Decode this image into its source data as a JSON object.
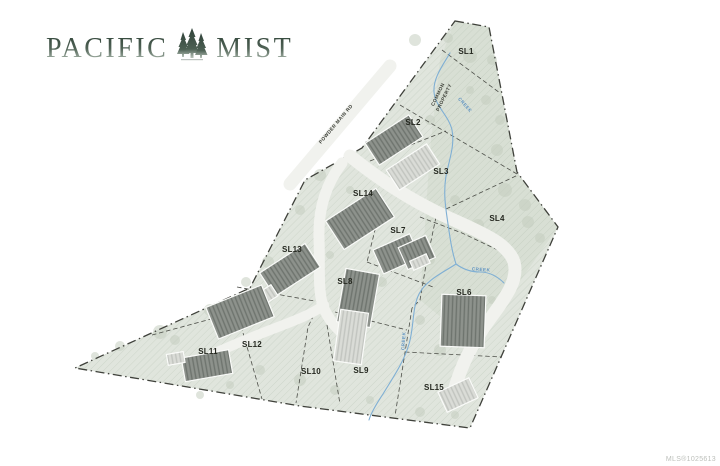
{
  "logo": {
    "word_left": "PACIFIC",
    "word_right": "MIST",
    "icon": "pine-tree-cluster-icon"
  },
  "map": {
    "road_label": "POWDER MAIN RD",
    "common_property_line1": "COMMON",
    "common_property_line2": "PROPERTY",
    "creek_label": "CREEK",
    "lots": [
      {
        "id": "SL1"
      },
      {
        "id": "SL2"
      },
      {
        "id": "SL3"
      },
      {
        "id": "SL4"
      },
      {
        "id": "SL6"
      },
      {
        "id": "SL7"
      },
      {
        "id": "SL8"
      },
      {
        "id": "SL9"
      },
      {
        "id": "SL10"
      },
      {
        "id": "SL11"
      },
      {
        "id": "SL12"
      },
      {
        "id": "SL13"
      },
      {
        "id": "SL14"
      },
      {
        "id": "SL15"
      }
    ],
    "mls_number": "MLS®1025613",
    "colors": {
      "site_fill": "#e0e5dd",
      "east_tint": "#ccd7c7",
      "road": "#f1f2ee",
      "creek": "#7fafd4",
      "boundary": "#3f413b",
      "lot_line": "#4c4e48",
      "building_dark": "#8d928c",
      "building_light": "#dadcd7",
      "logo_green": "#47584c"
    }
  }
}
